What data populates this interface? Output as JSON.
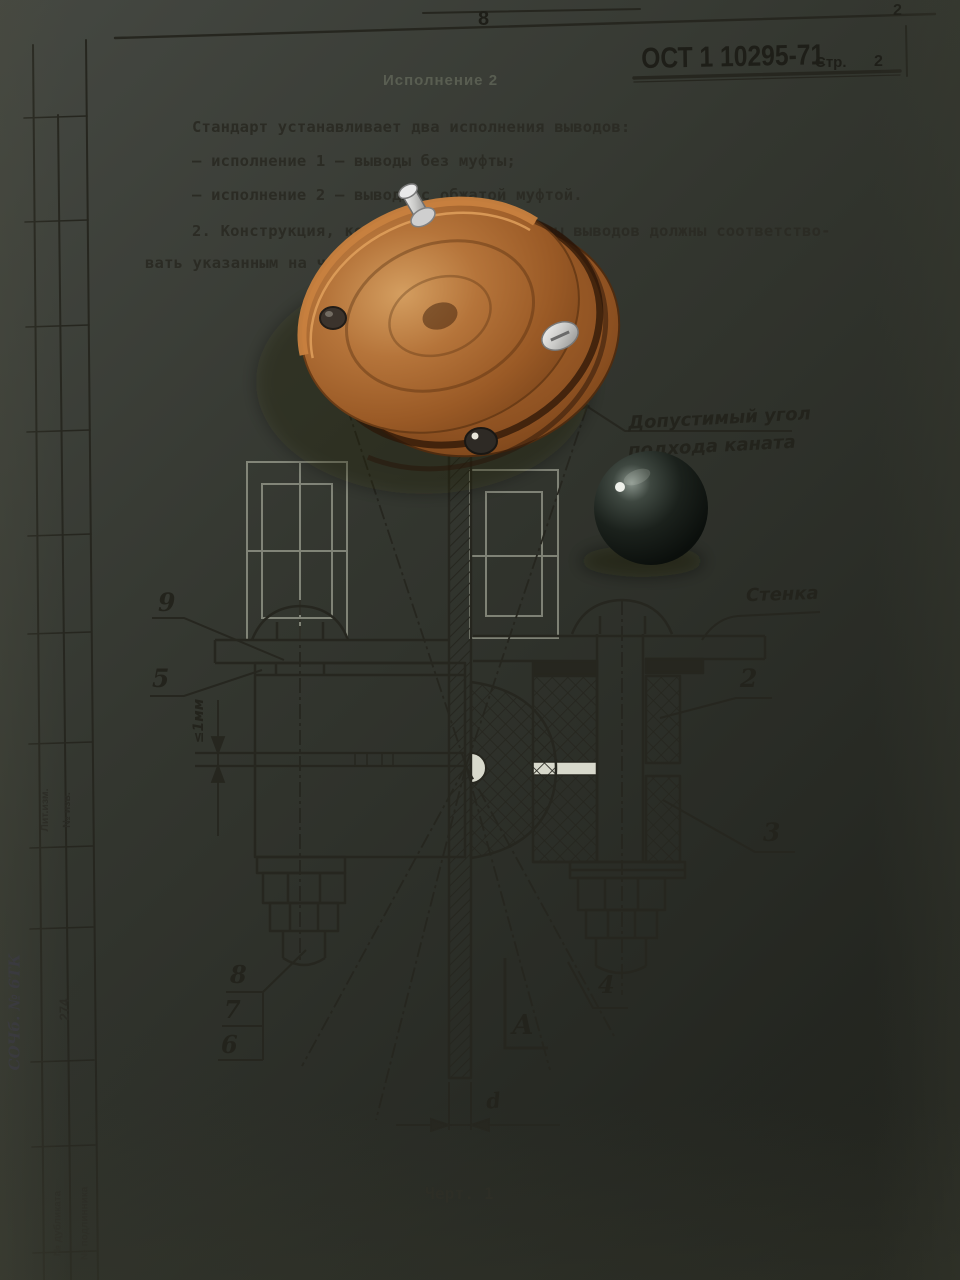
{
  "page": {
    "top_marker": "8",
    "corner_number": "2"
  },
  "header": {
    "standard": "ОСТ 1 10295-71",
    "page_label": "Стр.",
    "page_number": "2"
  },
  "body_text": {
    "p1": "Стандарт устанавливает два исполнения выводов:",
    "p2": "– исполнение 1 – выводы без муфты;",
    "p3": "– исполнение 2 – выводы с обжатой муфтой.",
    "p4": "2. Конструкция, комплектность и размеры выводов должны соответство-",
    "p5": "вать указанным на чертеже и в таблице."
  },
  "ghost": {
    "showthrough": "Исполнение 2"
  },
  "drawing": {
    "caption": "Черт. 1",
    "labels": {
      "angle_note_1": "Допустимый угол",
      "angle_note_2": "подхода каната",
      "wall": "Стенка",
      "angle_value": "≤20°",
      "gap_dimension": "≤1мм",
      "diameter": "d",
      "view": "А"
    },
    "callouts": {
      "c9": "9",
      "c5": "5",
      "c2": "2",
      "c3": "3",
      "c8": "8",
      "c7": "7",
      "c6": "6",
      "c4": "4"
    }
  },
  "margin": {
    "stamp_top_col1": "Лит.изм.",
    "stamp_top_col2": "№ изв.",
    "inventory_number": "274",
    "stamp_bottom_col1": "№ дубликата",
    "stamp_bottom_col2": "№ подлинника",
    "handwritten_note": "СОЧб. № 6ТК"
  },
  "colors": {
    "paper": "#d8d9cc",
    "ink": "#26261f",
    "wood": "#b5743a",
    "copper": "#c8813f",
    "sphere": "#1b211c",
    "table": "#33362f"
  }
}
